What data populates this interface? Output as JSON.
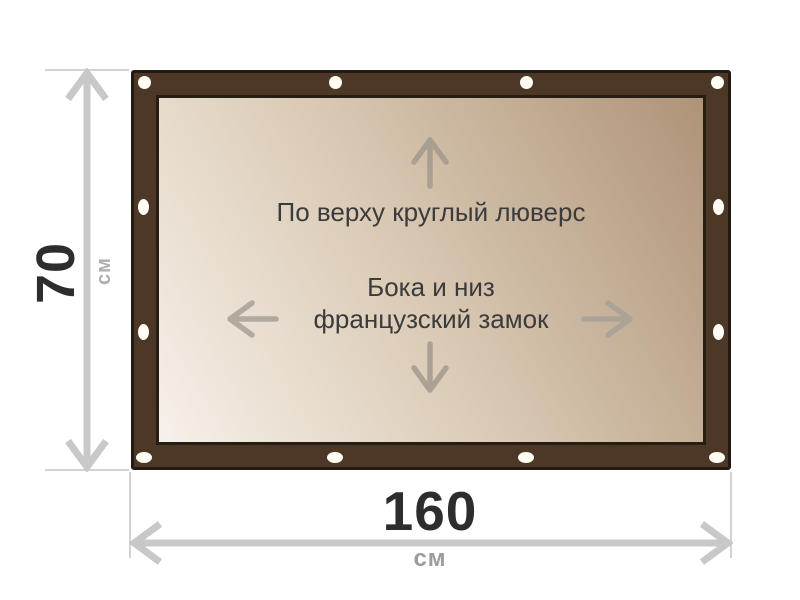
{
  "product_diagram": {
    "top_note": "По верху круглый люверс",
    "side_note_line1": "Бока и низ",
    "side_note_line2": "французский замок"
  },
  "dimensions": {
    "height_value": "70",
    "height_unit": "см",
    "width_value": "160",
    "width_unit": "см"
  },
  "icons": {
    "canvas_arrows": [
      "arrow-up-icon",
      "arrow-down-icon",
      "arrow-left-icon",
      "arrow-right-icon"
    ],
    "dimension_arrows": [
      "vertical-dimension-arrow-icon",
      "horizontal-dimension-arrow-icon"
    ],
    "fasteners": [
      "round-grommet",
      "french-lock-slot"
    ]
  },
  "colors": {
    "frame_brown": "#4d3827",
    "frame_outline": "#231a11",
    "canvas_gradient_light": "#f6f1ea",
    "canvas_gradient_dark": "#ae9378",
    "grommet_white": "#fffdf4",
    "canvas_arrow_gray": "#a39a8e",
    "dimension_line_gray": "#c8c8c8",
    "witness_line_gray": "#d2d2d2",
    "number_dark": "#2d2d2d",
    "unit_gray": "#9c9c9c",
    "note_text": "#3b3b3b",
    "background": "#ffffff"
  }
}
